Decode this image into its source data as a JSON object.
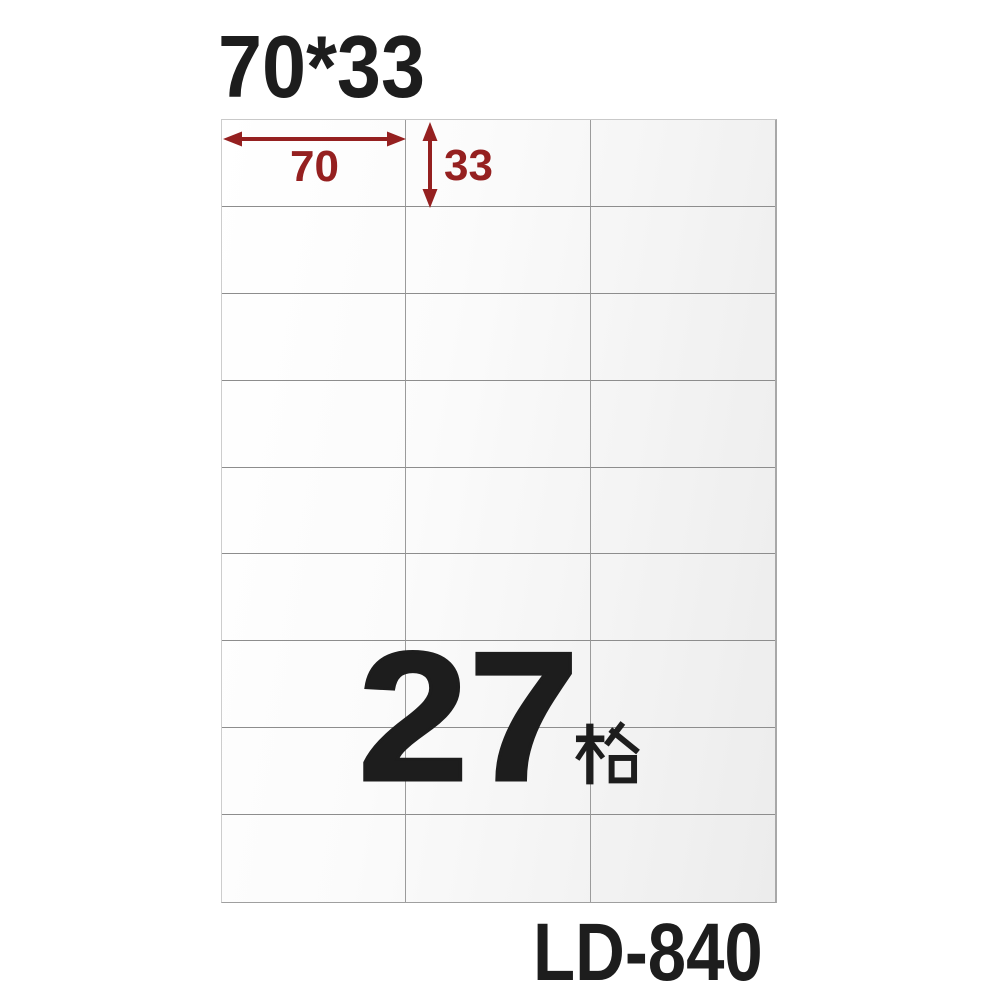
{
  "title": {
    "text": "70*33"
  },
  "sheet": {
    "rows": 9,
    "columns": 3,
    "cell_width_mm": "70",
    "cell_height_mm": "33"
  },
  "dimensions": {
    "width_value": "70",
    "height_value": "33"
  },
  "count": {
    "number": "27",
    "unit_cjk": "格"
  },
  "product_code": {
    "text": "LD-840"
  },
  "colors": {
    "ink": "#1d1d1d",
    "accent_red": "#952020",
    "sheet_gradient_start": "#ffffff",
    "sheet_gradient_end": "#ececec",
    "grid_line": "#8d8d8d"
  }
}
